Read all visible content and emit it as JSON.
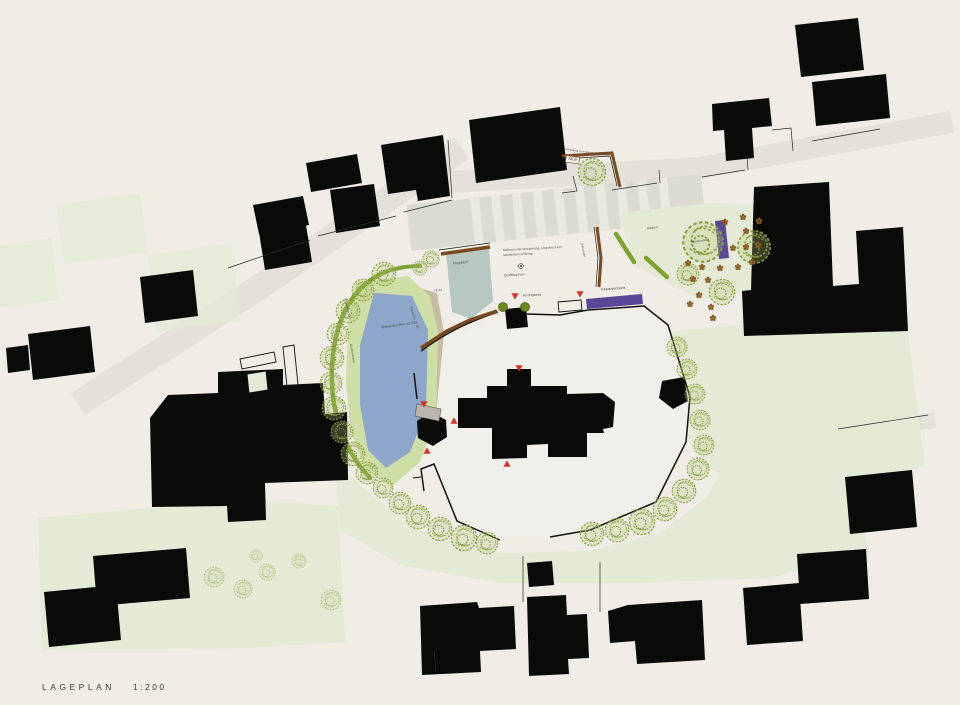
{
  "title": {
    "name": "LAGEPLAN",
    "scale": "1:200"
  },
  "annotations": {
    "flugdach": "Flugdach",
    "maibaum_line1": "Maibaum mit Umzäunung, eingefasst von",
    "maibaum_line2": "sandfarbenem Belag",
    "dorfbrunnen": "Dorfbrunnen",
    "wasserbecken": "Wasserbecken ±0,00",
    "sitzstufen": "Sitzstufen +0,40",
    "niveau": "+0,40",
    "strauchhecke": "Strauchhecke",
    "blumenwiese": "Blumenwiese",
    "rampe": "Rampe 6%",
    "bank": "Bank",
    "gasse": "Kirchgasse",
    "sitzbank": "Kastanienbank",
    "rasen": "Rasen",
    "staudenbeet": "Staudenbeet",
    "einfriedung": "Einfriedung zum Nachbargrundstück",
    "muell": "Müll",
    "sitzmauer": "Sitzmauer"
  },
  "colors": {
    "background": "#EFEDE6",
    "building": "#0A0A09",
    "water": "#8EA6C9",
    "basin": "#B6C8C1",
    "lawn": "#E4EAD6",
    "lawn_bright": "#CDDEA6",
    "hedge": "#7FA32F",
    "bench_wood": "#7A4A1E",
    "bench_purple": "#5B4798",
    "marker_red": "#D93025",
    "sand": "#C9BAA6",
    "road": "#E3E1DA",
    "plaza": "#F1EFE9"
  }
}
